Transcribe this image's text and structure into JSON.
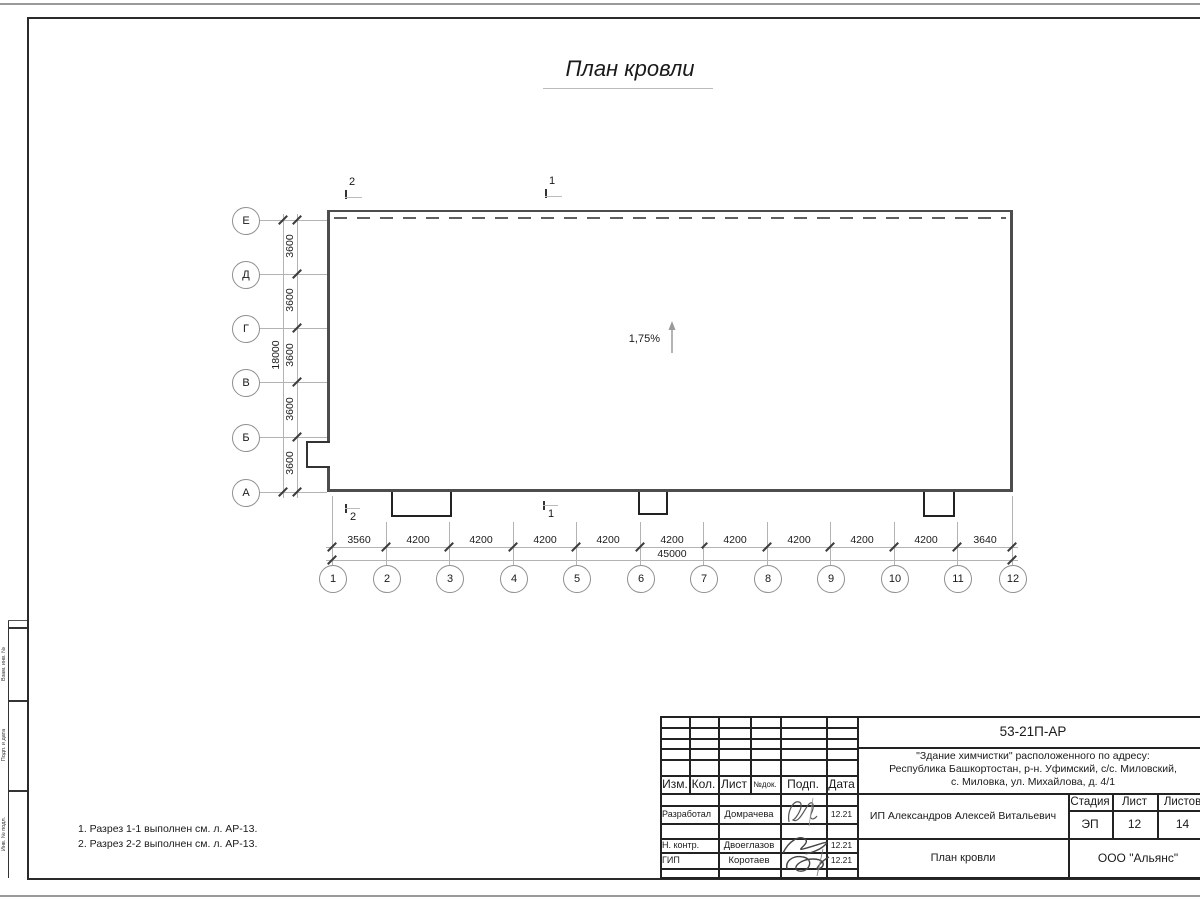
{
  "title": "План кровли",
  "plan": {
    "slope": "1,75%",
    "axes_left": [
      "Е",
      "Д",
      "Г",
      "В",
      "Б",
      "А"
    ],
    "axes_bottom": [
      "1",
      "2",
      "3",
      "4",
      "5",
      "6",
      "7",
      "8",
      "9",
      "10",
      "11",
      "12"
    ],
    "dims_left": [
      "3600",
      "3600",
      "3600",
      "3600",
      "3600"
    ],
    "dim_left_total": "18000",
    "dims_bottom": [
      "3560",
      "4200",
      "4200",
      "4200",
      "4200",
      "4200",
      "4200",
      "4200",
      "4200",
      "4200",
      "3640"
    ],
    "dim_bottom_total": "45000",
    "sections": {
      "s1": "1",
      "s2": "2"
    }
  },
  "notes": [
    "1. Разрез 1-1 выполнен см. л. АР-13.",
    "2. Разрез 2-2 выполнен см. л. АР-13."
  ],
  "frame_side_labels": [
    "Взам. инв. №",
    "Подп. и дата",
    "Инв. № подл."
  ],
  "title_block": {
    "code": "53-21П-АР",
    "project_line1": "\"Здание химчистки\" расположенного по адресу:",
    "project_line2": "Республика Башкортостан, р-н. Уфимский, с/с. Миловский,",
    "project_line3": "с. Миловка, ул. Михайлова, д. 4/1",
    "header": [
      "Изм.",
      "Кол.",
      "Лист",
      "№док.",
      "Подп.",
      "Дата"
    ],
    "rows": [
      {
        "role": "Разработал",
        "name": "Домрачева",
        "date": "12.21"
      },
      {
        "role": "Н. контр.",
        "name": "Двоеглазов",
        "date": "12.21"
      },
      {
        "role": "ГИП",
        "name": "Коротаев",
        "date": "12.21"
      }
    ],
    "client": "ИП Александров Алексей Витальевич",
    "stage_label": "Стадия",
    "sheet_label": "Лист",
    "sheets_label": "Листов",
    "stage": "ЭП",
    "sheet": "12",
    "sheets": "14",
    "doc_title": "План кровли",
    "company": "ООО \"Альянс\""
  }
}
